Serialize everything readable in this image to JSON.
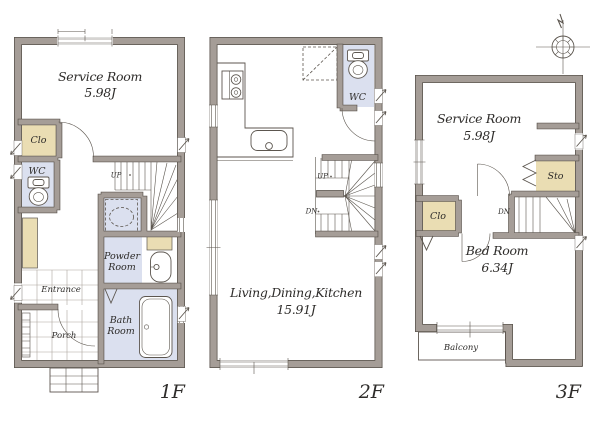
{
  "colors": {
    "wall_fill": "#a59d97",
    "wall_outline": "#5c564f",
    "closet_fill": "#eaddb3",
    "wet_area_fill": "#dbe0ef",
    "tile_line": "#aba49d",
    "text": "#2e2c2a"
  },
  "floors": [
    {
      "label": "1F",
      "rooms": {
        "service": {
          "name": "Service Room",
          "area": "5.98J"
        },
        "clo": {
          "name": "Clo"
        },
        "wc": {
          "name": "WC"
        },
        "powder": {
          "name": "Powder Room",
          "lines": [
            "Powder",
            "Room"
          ]
        },
        "entrance": {
          "name": "Entrance"
        },
        "porch": {
          "name": "Porch"
        },
        "bath": {
          "name": "Bath Room",
          "lines": [
            "Bath",
            "Room"
          ]
        }
      },
      "stairs": {
        "up": "UP"
      }
    },
    {
      "label": "2F",
      "rooms": {
        "ldk": {
          "name": "Living,Dining,Kitchen",
          "area": "15.91J"
        },
        "wc": {
          "name": "WC"
        }
      },
      "stairs": {
        "up": "UP",
        "down": "DN"
      }
    },
    {
      "label": "3F",
      "rooms": {
        "service": {
          "name": "Service Room",
          "area": "5.98J"
        },
        "sto": {
          "name": "Sto"
        },
        "clo": {
          "name": "Clo"
        },
        "bed": {
          "name": "Bed Room",
          "area": "6.34J"
        },
        "balcony": {
          "name": "Balcony"
        }
      },
      "stairs": {
        "down": "DN"
      }
    }
  ]
}
